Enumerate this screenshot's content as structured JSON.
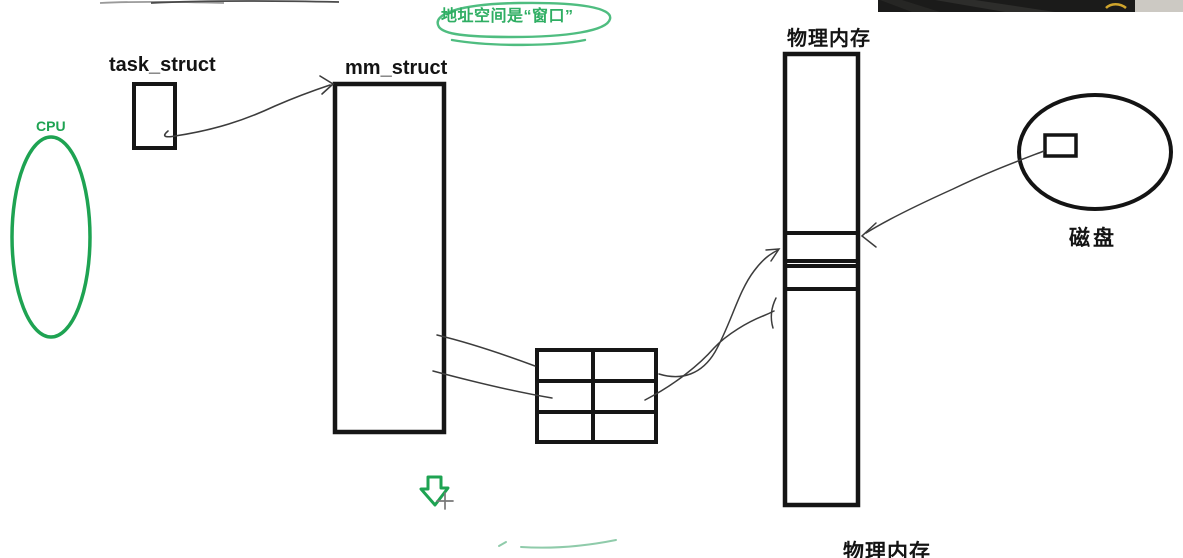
{
  "annotation_bubble": {
    "text": "地址空间是“窗口”"
  },
  "nodes": {
    "cpu": {
      "label": "CPU",
      "shape": "ellipse"
    },
    "task_struct": {
      "label": "task_struct",
      "shape": "rect"
    },
    "mm_struct": {
      "label": "mm_struct",
      "shape": "rect"
    },
    "page_table": {
      "shape": "grid",
      "rows": 3,
      "cols": 2
    },
    "physical_memory": {
      "label": "物理内存",
      "shape": "rect",
      "sub_cells": 2
    },
    "disk": {
      "label": "磁盘",
      "shape": "ellipse",
      "has_block": true
    }
  },
  "edges": [
    {
      "from": "task_struct",
      "to": "mm_struct",
      "style": "arrow"
    },
    {
      "from": "mm_struct",
      "to": "page_table",
      "style": "line",
      "count": 2
    },
    {
      "from": "page_table",
      "to": "physical_memory",
      "style": "arrow",
      "count": 2
    },
    {
      "from": "disk_block",
      "to": "physical_memory",
      "style": "arrow"
    }
  ],
  "bottom_partial_label": {
    "text": "物理内存"
  },
  "icons": {
    "down_arrow": "green-outlined-down-arrow",
    "cursor": "crosshair-cursor"
  },
  "colors": {
    "accent_green": "#1ea352",
    "bubble_green": "#3db46d",
    "sketch_black": "#161616",
    "strip_dark": "#1b1b1a",
    "strip_light": "#ccc9c3",
    "arc_green": "#8fcbaa",
    "cursor_gray": "#787878",
    "yellow_mark": "#cfa42c"
  }
}
